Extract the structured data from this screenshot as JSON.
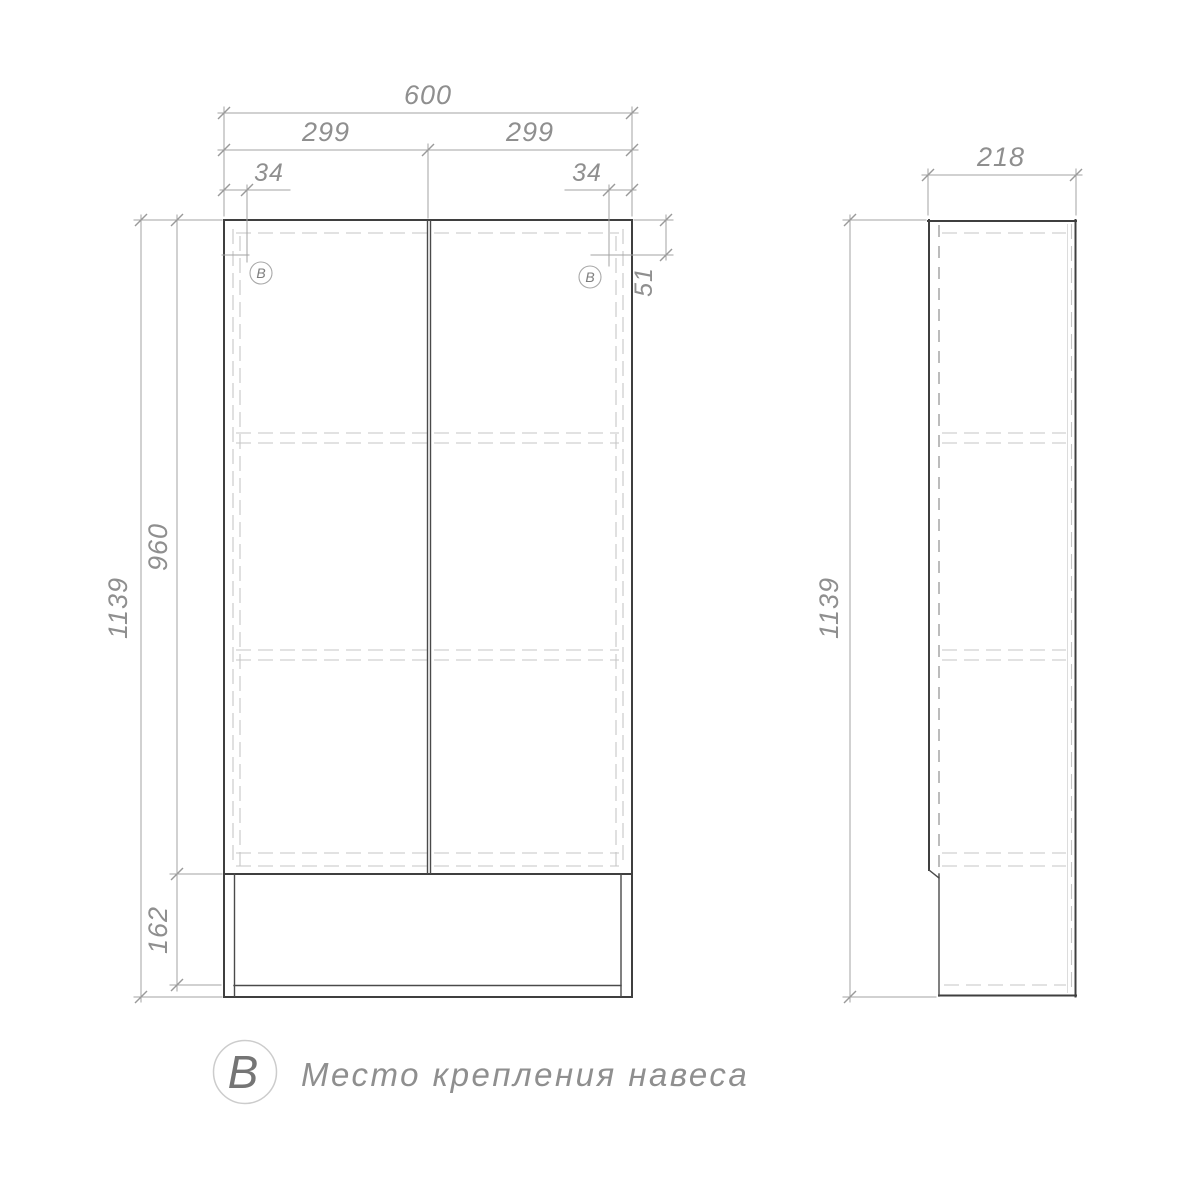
{
  "drawing": {
    "type": "furniture technical drawing, cabinet two views",
    "front_view": {
      "width_total": "600",
      "width_door_left": "299",
      "width_door_right": "299",
      "mount_offset_left": "34",
      "mount_offset_right": "34",
      "mount_offset_top": "51",
      "height_total": "1139",
      "height_doors": "960",
      "height_niche": "162",
      "mount_callout_left": "В",
      "mount_callout_right": "В"
    },
    "side_view": {
      "depth": "218",
      "height_total": "1139"
    },
    "legend": {
      "symbol": "В",
      "description": "Место крепления навеса"
    },
    "colors": {
      "background": "#ffffff",
      "outline": "#3f3f3f",
      "dimension_lines": "#a3a3a3",
      "hidden_lines": "#c6c6c6",
      "text": "#8f8f8f"
    }
  }
}
